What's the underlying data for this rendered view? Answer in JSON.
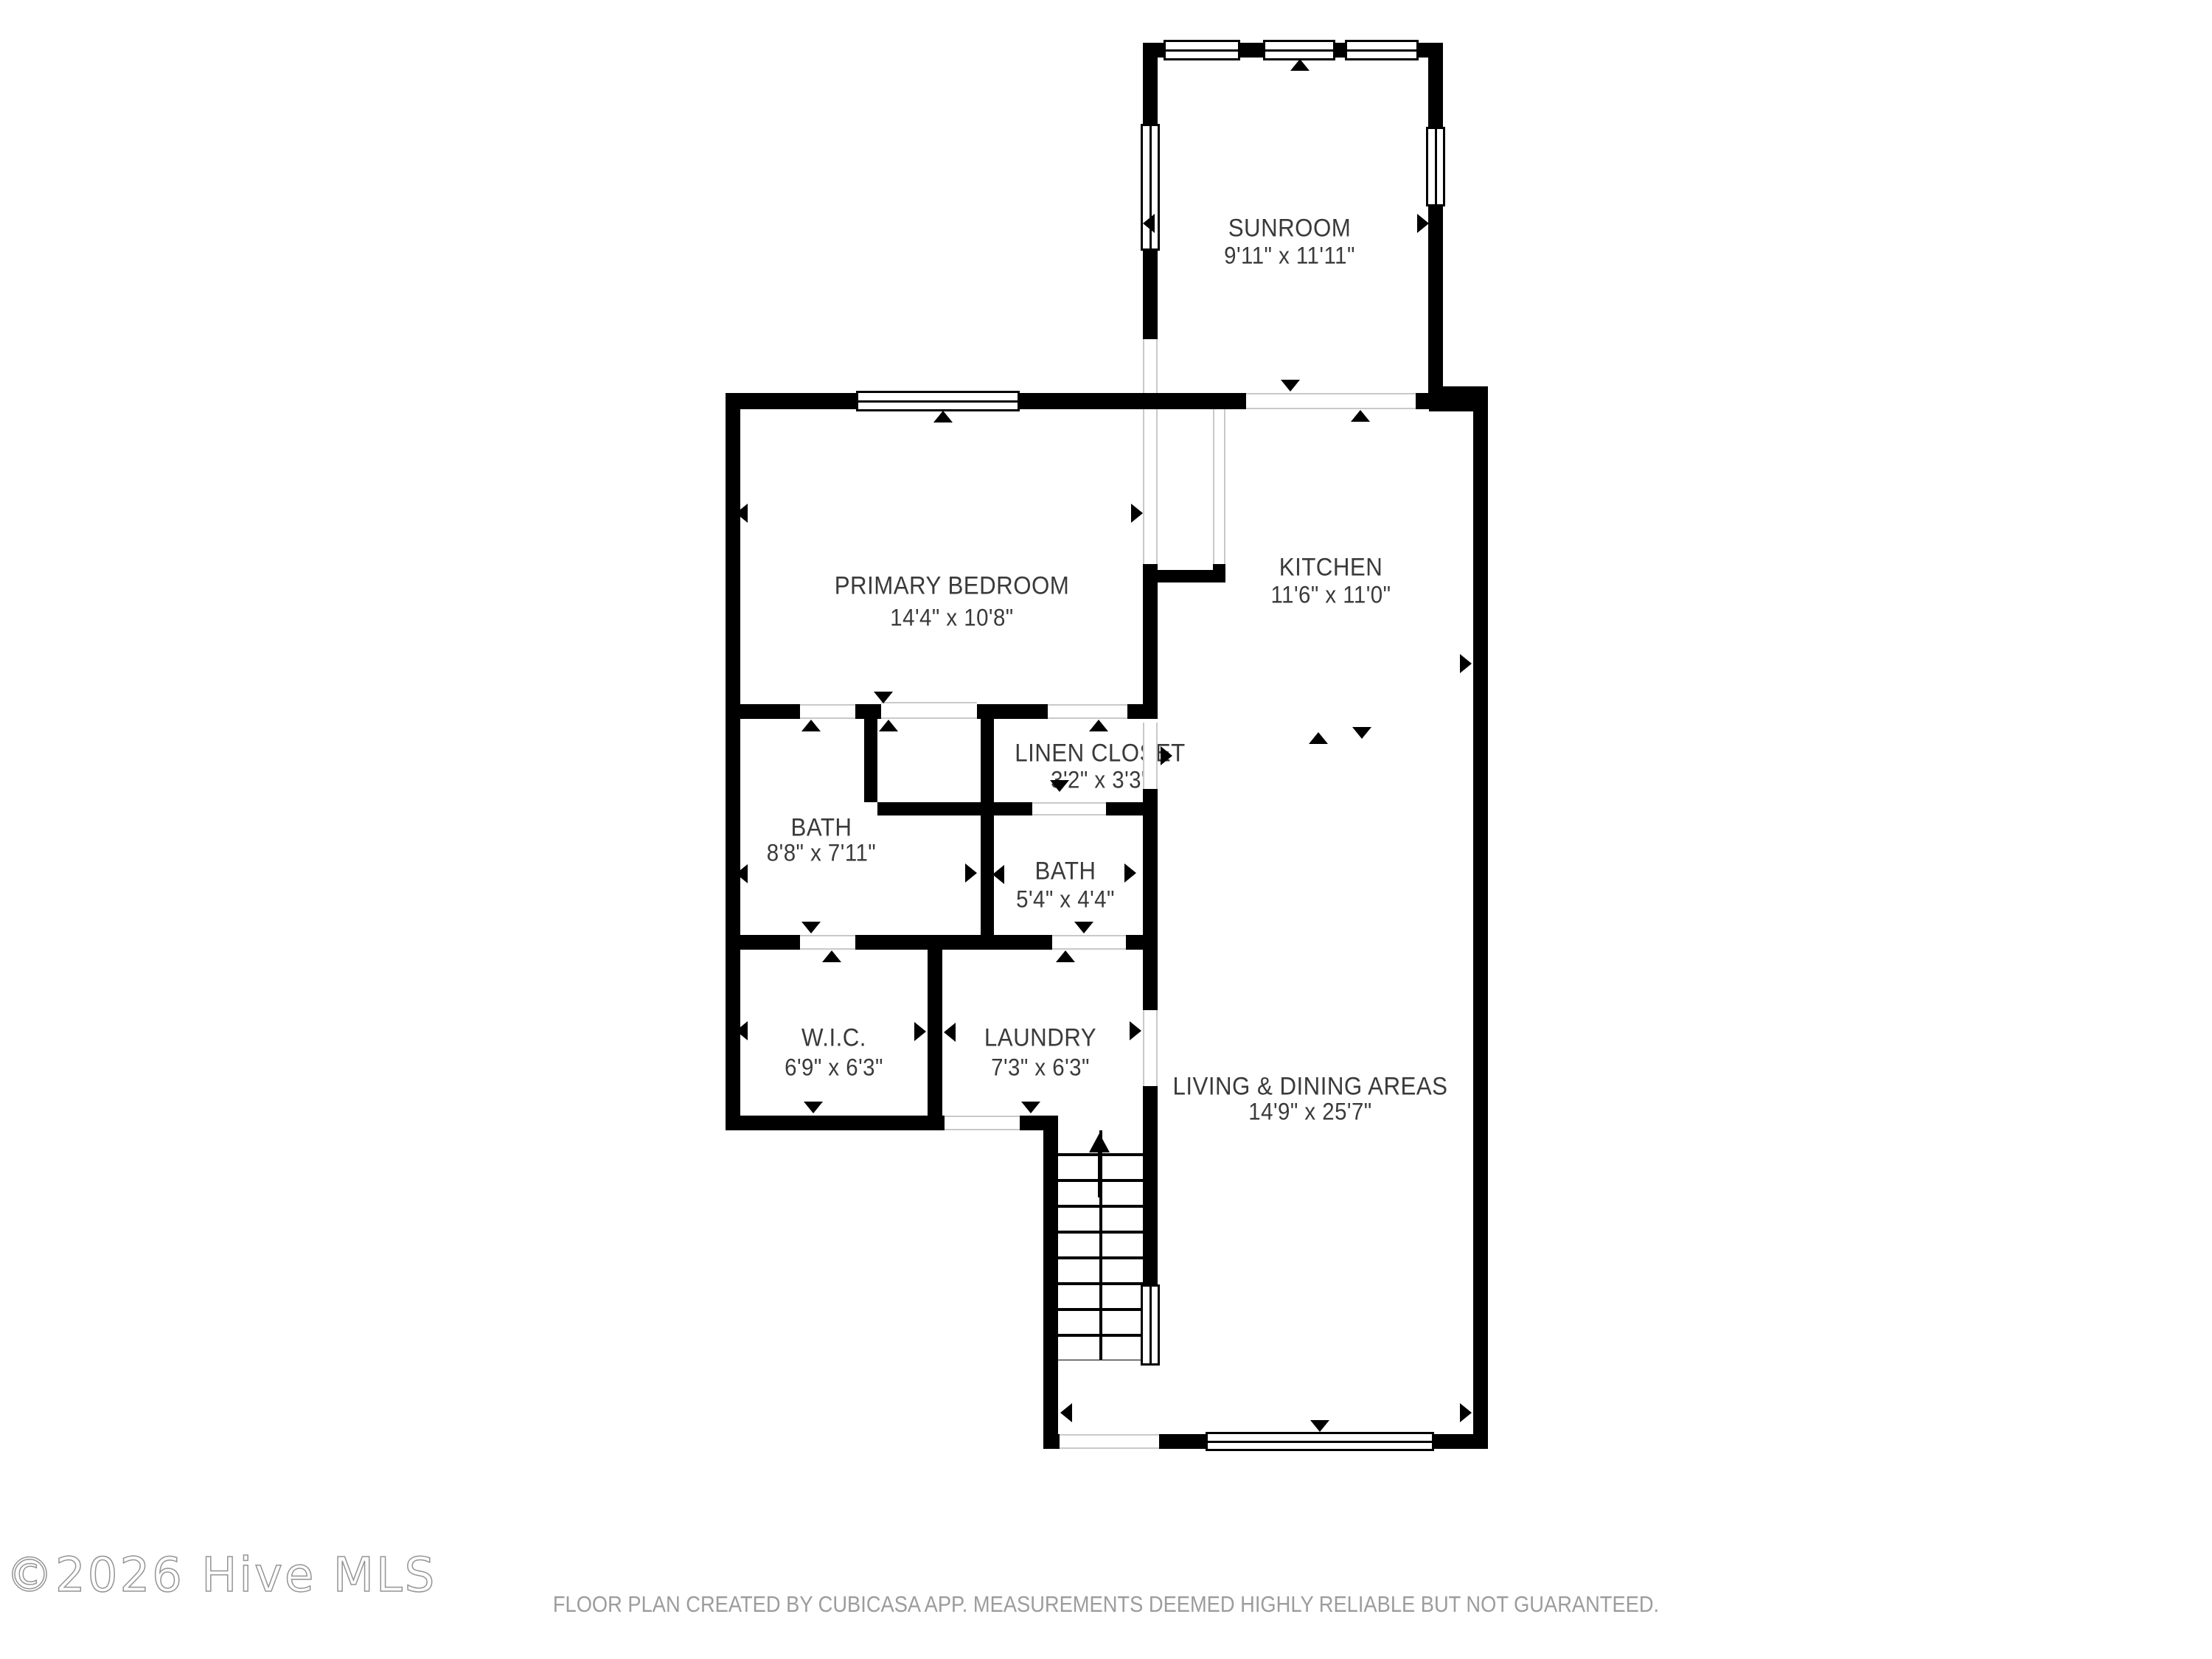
{
  "rooms": {
    "sunroom": {
      "name": "SUNROOM",
      "dims": "9'11\" x 11'11\""
    },
    "primary_bedroom": {
      "name": "PRIMARY BEDROOM",
      "dims": "14'4\" x 10'8\""
    },
    "kitchen": {
      "name": "KITCHEN",
      "dims": "11'6\" x 11'0\""
    },
    "linen_closet": {
      "name": "LINEN CLOSET",
      "dims": "3'2\" x 3'3\""
    },
    "bath_main": {
      "name": "BATH",
      "dims": "8'8\" x 7'11\""
    },
    "bath_half": {
      "name": "BATH",
      "dims": "5'4\" x 4'4\""
    },
    "wic": {
      "name": "W.I.C.",
      "dims": "6'9\" x 6'3\""
    },
    "laundry": {
      "name": "LAUNDRY",
      "dims": "7'3\" x 6'3\""
    },
    "living_dining": {
      "name": "LIVING & DINING AREAS",
      "dims": "14'9\" x 25'7\""
    }
  },
  "footer": {
    "text": "FLOOR PLAN CREATED BY CUBICASA APP. MEASUREMENTS DEEMED HIGHLY RELIABLE BUT NOT GUARANTEED."
  },
  "watermark": {
    "text": "©2026 Hive MLS"
  },
  "colors": {
    "wall": "#000000",
    "label_text": "#3a3a3a",
    "footer_text": "#9c9c9c",
    "watermark_outline": "#828282",
    "opening_line": "#c9c9c9",
    "background": "#ffffff"
  },
  "icons": {
    "door-swing-arrow": "small black triangle",
    "stairs-up-arrow": "black arrow pointing up",
    "window": "white bar with black frame and center line",
    "door-opening": "white gap with thin gray edge lines"
  }
}
